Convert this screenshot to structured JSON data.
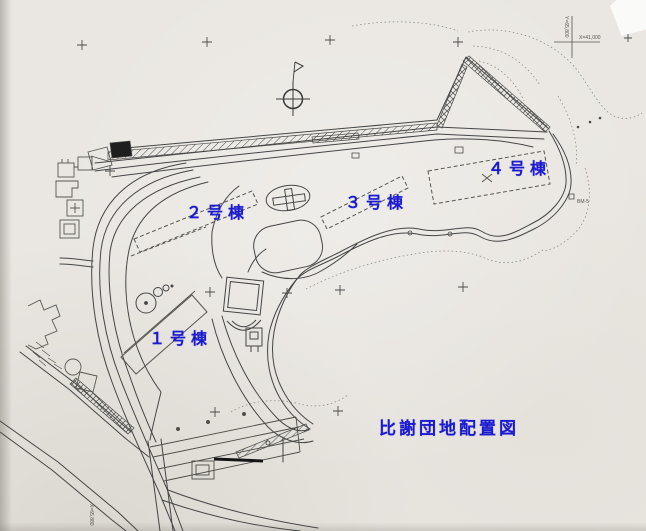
{
  "plan": {
    "title": "比謝団地配置図",
    "buildings": [
      {
        "label": "１号棟"
      },
      {
        "label": "２号棟"
      },
      {
        "label": "３号棟"
      },
      {
        "label": "４号棟"
      }
    ],
    "survey": {
      "grid_vertical_label": "Y=65,800",
      "grid_horizontal_label": "X=41,000",
      "benchmark_label": "BM-5",
      "bottom_coord_label": "X=65,880"
    },
    "symbols": {
      "north_arrow": "north-arrow",
      "survey_cross": "survey-cross-mark",
      "benchmark": "benchmark-square"
    },
    "colors": {
      "paper": "#eae7e2",
      "ink": "#454545",
      "label_blue": "#1a1ad0"
    }
  }
}
